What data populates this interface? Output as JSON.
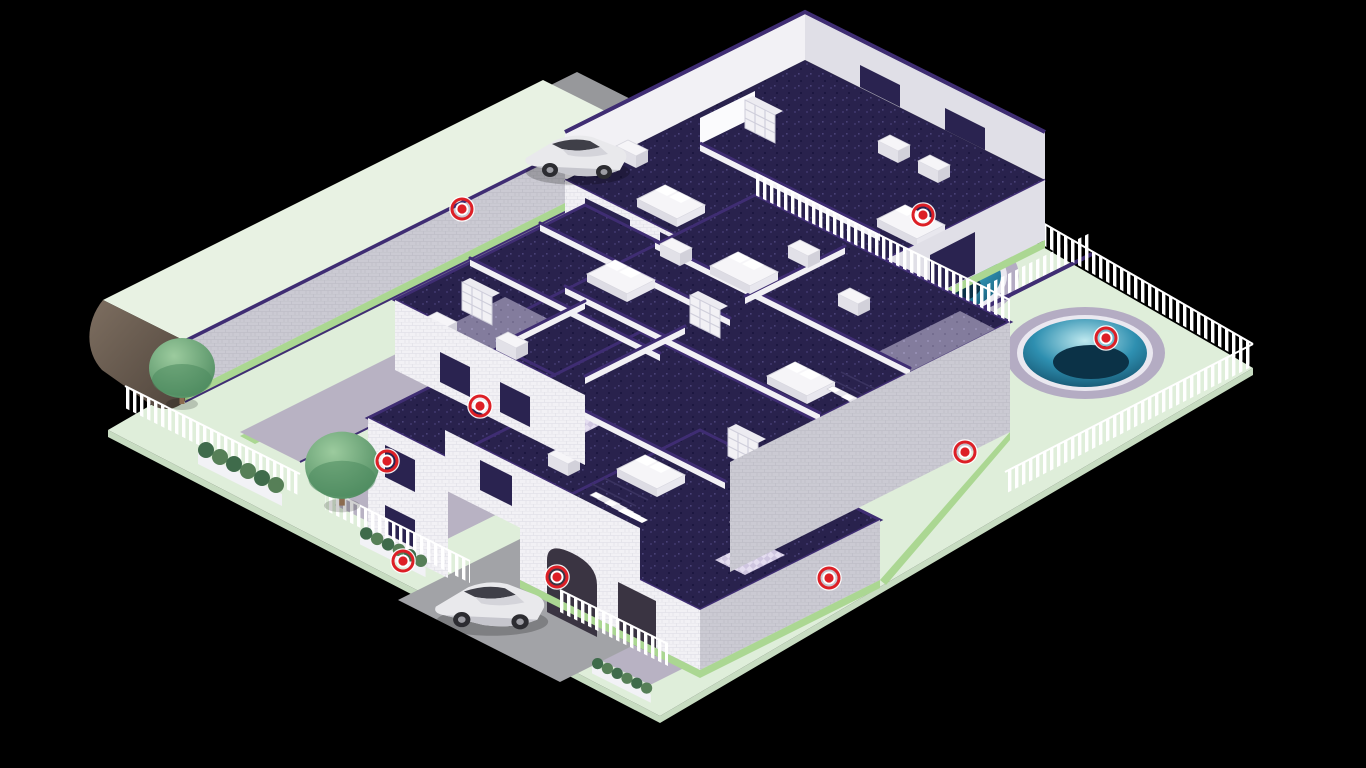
{
  "scene": {
    "description": "Isometric cutaway illustration of a residential property on a dark background: a large cutaway apartment building with furnished bedrooms and bathrooms, a two-story guest house, a long barn with pale-green roof, two circular swimming pools with sun loungers, white picket fencing, hedges, trees, two silver cars and red hotspot markers.",
    "inventory": {
      "buildings": [
        "main-building",
        "guest-house",
        "barn"
      ],
      "pools": 2,
      "cars": 2,
      "trees": 2,
      "sun_loungers": 4,
      "hedge_planters": 3,
      "hotspots": 9
    }
  },
  "palette": {
    "background": "#000000",
    "lawn": "#dfeeda",
    "lawn_edge": "#c7dcc1",
    "grass": "#abd792",
    "hedge": "#567f57",
    "hedge_dark": "#3f6b4b",
    "tree_light": "#9ccb9e",
    "tree_dark": "#4d8a5f",
    "trunk": "#8b6b4f",
    "road": "#97989b",
    "road_dark": "#8a8b8e",
    "driveway": "#a2a3a7",
    "path": "#b8b2c3",
    "wall_white": "#f2f1f5",
    "wall_shade": "#e0dfe7",
    "wall_gray": "#cbcad3",
    "trim_purple": "#3f2d73",
    "window_dark": "#2a2350",
    "floor_dark": "#29224d",
    "floor_mid": "#837c9d",
    "bathroom_tile": "#cfc6e0",
    "pool_rim": "#b4acc3",
    "water_light": "#bfe9ef",
    "water_mid": "#2e8fb0",
    "water_dark": "#14506b",
    "water_deep": "#0b3247",
    "fence_white": "#ffffff",
    "marker_red": "#dd1f26",
    "car_silver": "#e9e9ec",
    "barn_roof": "#e8f2e3",
    "barn_brown": "#6d5e52"
  },
  "marker_style": {
    "halo_radius": 12,
    "outer_radius": 10,
    "ring_width": 3,
    "mid_radius": 6.5,
    "core_radius": 4.6,
    "color": "#dd1f26"
  },
  "hotspots": [
    {
      "id": 1,
      "x": 462,
      "y": 209,
      "area": "barn-wall"
    },
    {
      "id": 2,
      "x": 923,
      "y": 215,
      "area": "pool-retaining-wall"
    },
    {
      "id": 3,
      "x": 1106,
      "y": 338,
      "area": "pool-2-water"
    },
    {
      "id": 4,
      "x": 480,
      "y": 406,
      "area": "west-wing-wall"
    },
    {
      "id": 5,
      "x": 387,
      "y": 461,
      "area": "west-annex-wall"
    },
    {
      "id": 6,
      "x": 403,
      "y": 561,
      "area": "southwest-hedge"
    },
    {
      "id": 7,
      "x": 557,
      "y": 577,
      "area": "garage-arch"
    },
    {
      "id": 8,
      "x": 829,
      "y": 578,
      "area": "south-wall"
    },
    {
      "id": 9,
      "x": 965,
      "y": 452,
      "area": "east-terrace"
    }
  ]
}
